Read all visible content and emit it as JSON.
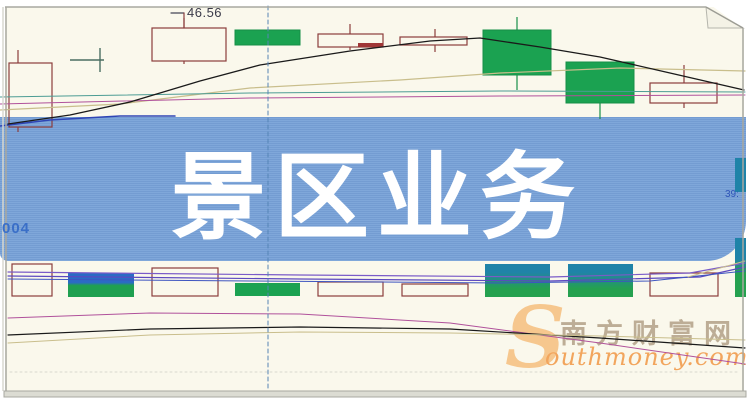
{
  "page": {
    "background": "#FAF8EC"
  },
  "banner": {
    "title": "景区业务",
    "bg_color": "#78A2D8",
    "text_color": "#FFFFFF",
    "stock_code_fragment": "004",
    "right_edge_label": "39:"
  },
  "callout": {
    "price": "46.56"
  },
  "watermark": {
    "cn": "南方财富网",
    "en_initial": "S",
    "en_rest": "outhmoney.com"
  },
  "chart_data": {
    "type": "candlestick",
    "title": "",
    "note": "Daily K-line chart with MA overlay lines; central blue banner overlays mid prices; only visible price label is 46.56",
    "price_label": "46.56",
    "palette": {
      "hollow_stroke": "#8B3D3D",
      "green_fill": "#1BA251",
      "green_stroke": "#178F48",
      "royal_blue": "#2B6BC4",
      "teal_fill": "#1F83A8",
      "black_ma": "#1a1a1a",
      "tan_ma": "#C9BE8C",
      "magenta_ma": "#B0519B",
      "teal_ma": "#4C9C94",
      "blue_ma": "#2F45B5",
      "purple1": "#7A5BC8",
      "purple2": "#5D49C0",
      "strip_blue": "#3E55C0",
      "crosshair": "#5585B5",
      "doji": "#4A6E62",
      "gridline": "#D8D8CE"
    },
    "upper_candles": [
      {
        "kind": "hollow",
        "x": 9,
        "w": 43,
        "top": 63,
        "bottom": 127,
        "wick_x": 18,
        "wick_top": 50,
        "wick_bottom": 132
      },
      {
        "kind": "cross",
        "h_x1": 70,
        "h_x2": 104,
        "h_y": 60,
        "v_x": 100,
        "v_y1": 48,
        "v_y2": 72
      },
      {
        "kind": "hollow",
        "x": 152,
        "w": 74,
        "top": 28,
        "bottom": 61,
        "wick_x": 184,
        "wick_top": 18,
        "wick_bottom": 64
      },
      {
        "kind": "solid",
        "x": 235,
        "w": 65,
        "top": 30,
        "bottom": 45
      },
      {
        "kind": "hollow",
        "x": 318,
        "w": 65,
        "top": 34,
        "bottom": 47,
        "wick_x": 350,
        "wick_top": 24,
        "wick_bottom": 50,
        "extra_rect": {
          "x": 358,
          "w": 25,
          "y": 43,
          "h": 4
        }
      },
      {
        "kind": "hollow",
        "x": 400,
        "w": 67,
        "top": 37,
        "bottom": 45,
        "wick_x": 435,
        "wick_top": 29,
        "wick_bottom": 52
      },
      {
        "kind": "solid",
        "x": 483,
        "w": 68,
        "top": 30,
        "bottom": 75,
        "wick_x": 517,
        "wick_top": 17,
        "wick_bottom": 90
      },
      {
        "kind": "solid",
        "x": 566,
        "w": 68,
        "top": 62,
        "bottom": 103,
        "wick_x": 600,
        "wick_top": 62,
        "wick_bottom": 119
      },
      {
        "kind": "hollow",
        "x": 650,
        "w": 67,
        "top": 83,
        "bottom": 103,
        "wick_x": 684,
        "wick_top": 65,
        "wick_bottom": 108
      }
    ],
    "lower_bars": [
      {
        "kind": "hollow",
        "x": 12,
        "w": 40,
        "top": 264,
        "bottom": 296
      },
      {
        "kind": "grad",
        "x": 68,
        "w": 66,
        "top": 273,
        "bottom": 297,
        "c1": "#2B6BC4",
        "c2": "#1FA050",
        "s1": 40,
        "s2": 52
      },
      {
        "kind": "hollow",
        "x": 152,
        "w": 66,
        "top": 268,
        "bottom": 296
      },
      {
        "kind": "filled",
        "x": 235,
        "w": 65,
        "top": 283,
        "bottom": 296,
        "fill": "#1BA251"
      },
      {
        "kind": "hollow",
        "x": 318,
        "w": 65,
        "top": 282,
        "bottom": 296
      },
      {
        "kind": "hollow",
        "x": 402,
        "w": 66,
        "top": 284,
        "bottom": 296
      },
      {
        "kind": "grad",
        "x": 485,
        "w": 65,
        "top": 264,
        "bottom": 297,
        "c1": "#1F83A8",
        "c2": "#25A14F",
        "s1": 25,
        "s2": 75
      },
      {
        "kind": "grad",
        "x": 568,
        "w": 65,
        "top": 264,
        "bottom": 297,
        "c1": "#1F83A8",
        "c2": "#25A14F",
        "s1": 25,
        "s2": 75
      },
      {
        "kind": "hollow",
        "x": 650,
        "w": 68,
        "top": 273,
        "bottom": 296
      },
      {
        "kind": "grad",
        "x": 735,
        "w": 11,
        "top": 238,
        "bottom": 297,
        "c1": "#1F83A8",
        "c2": "#25A14F",
        "s1": 35,
        "s2": 60
      },
      {
        "kind": "filled",
        "x": 735,
        "w": 11,
        "top": 158,
        "bottom": 192,
        "fill": "#1F83A8"
      }
    ],
    "lines": [
      {
        "name": "ma-tan-upper",
        "color": "#C9BE8C",
        "width": 1.2,
        "points": [
          [
            0,
            110
          ],
          [
            120,
            104
          ],
          [
            250,
            88
          ],
          [
            400,
            80
          ],
          [
            500,
            73
          ],
          [
            620,
            68
          ],
          [
            745,
            71
          ]
        ]
      },
      {
        "name": "ma-teal-upper",
        "color": "#4C9C94",
        "width": 1,
        "points": [
          [
            0,
            97
          ],
          [
            250,
            93
          ],
          [
            500,
            91
          ],
          [
            745,
            92
          ]
        ]
      },
      {
        "name": "ma-magenta-upper",
        "color": "#B0519B",
        "width": 1,
        "points": [
          [
            0,
            104
          ],
          [
            250,
            98
          ],
          [
            500,
            96
          ],
          [
            745,
            95
          ]
        ]
      },
      {
        "name": "ma-blue-upper",
        "color": "#2F45B5",
        "width": 1.5,
        "points": [
          [
            0,
            126
          ],
          [
            50,
            120
          ],
          [
            120,
            116
          ],
          [
            175,
            116
          ]
        ]
      },
      {
        "name": "ma-black-upper",
        "color": "#1a1a1a",
        "width": 1.3,
        "points": [
          [
            8,
            124
          ],
          [
            70,
            115
          ],
          [
            130,
            102
          ],
          [
            200,
            81
          ],
          [
            260,
            65
          ],
          [
            350,
            51
          ],
          [
            430,
            41
          ],
          [
            480,
            38
          ],
          [
            540,
            47
          ],
          [
            600,
            57
          ],
          [
            670,
            73
          ],
          [
            744,
            90
          ]
        ]
      },
      {
        "name": "strip-purple-1",
        "color": "#7A5BC8",
        "width": 1.2,
        "points": [
          [
            8,
            272
          ],
          [
            300,
            275
          ],
          [
            550,
            277
          ],
          [
            690,
            273
          ],
          [
            745,
            263
          ]
        ]
      },
      {
        "name": "strip-purple-2",
        "color": "#5D49C0",
        "width": 1.2,
        "points": [
          [
            8,
            276
          ],
          [
            300,
            279
          ],
          [
            550,
            281
          ],
          [
            700,
            277
          ],
          [
            745,
            267
          ]
        ]
      },
      {
        "name": "strip-blue",
        "color": "#3E55C0",
        "width": 1,
        "points": [
          [
            8,
            279
          ],
          [
            250,
            281
          ],
          [
            500,
            283
          ],
          [
            650,
            281
          ],
          [
            745,
            271
          ]
        ]
      },
      {
        "name": "strip-tan",
        "color": "#C9BE8C",
        "width": 1,
        "points": [
          [
            688,
            277
          ],
          [
            720,
            268
          ],
          [
            745,
            261
          ]
        ]
      },
      {
        "name": "ma-magenta-lower",
        "color": "#B0519B",
        "width": 1,
        "points": [
          [
            8,
            318
          ],
          [
            150,
            313
          ],
          [
            300,
            314
          ],
          [
            450,
            323
          ],
          [
            600,
            343
          ],
          [
            745,
            364
          ]
        ]
      },
      {
        "name": "ma-black-lower",
        "color": "#1a1a1a",
        "width": 1.2,
        "points": [
          [
            8,
            335
          ],
          [
            150,
            329
          ],
          [
            300,
            327
          ],
          [
            450,
            329
          ],
          [
            600,
            338
          ],
          [
            745,
            348
          ]
        ]
      },
      {
        "name": "ma-tan-lower",
        "color": "#C9BE8C",
        "width": 1,
        "points": [
          [
            8,
            343
          ],
          [
            150,
            335
          ],
          [
            300,
            332
          ],
          [
            450,
            333
          ],
          [
            600,
            336
          ],
          [
            745,
            340
          ]
        ]
      },
      {
        "name": "gridline-dotted",
        "color": "#D8D8CE",
        "width": 1,
        "dash": "2,3",
        "points": [
          [
            10,
            372
          ],
          [
            740,
            372
          ]
        ]
      },
      {
        "name": "crosshair-vertical",
        "color": "#5585B5",
        "width": 1,
        "dash": "4,3",
        "points": [
          [
            268,
            6
          ],
          [
            268,
            391
          ]
        ]
      },
      {
        "name": "callout-tick-h",
        "color": "#444455",
        "width": 1.2,
        "points": [
          [
            171,
            13
          ],
          [
            184,
            13
          ]
        ]
      },
      {
        "name": "callout-tick-v",
        "color": "#8B3D3D",
        "width": 1.2,
        "points": [
          [
            184,
            13
          ],
          [
            184,
            28
          ]
        ]
      }
    ]
  }
}
